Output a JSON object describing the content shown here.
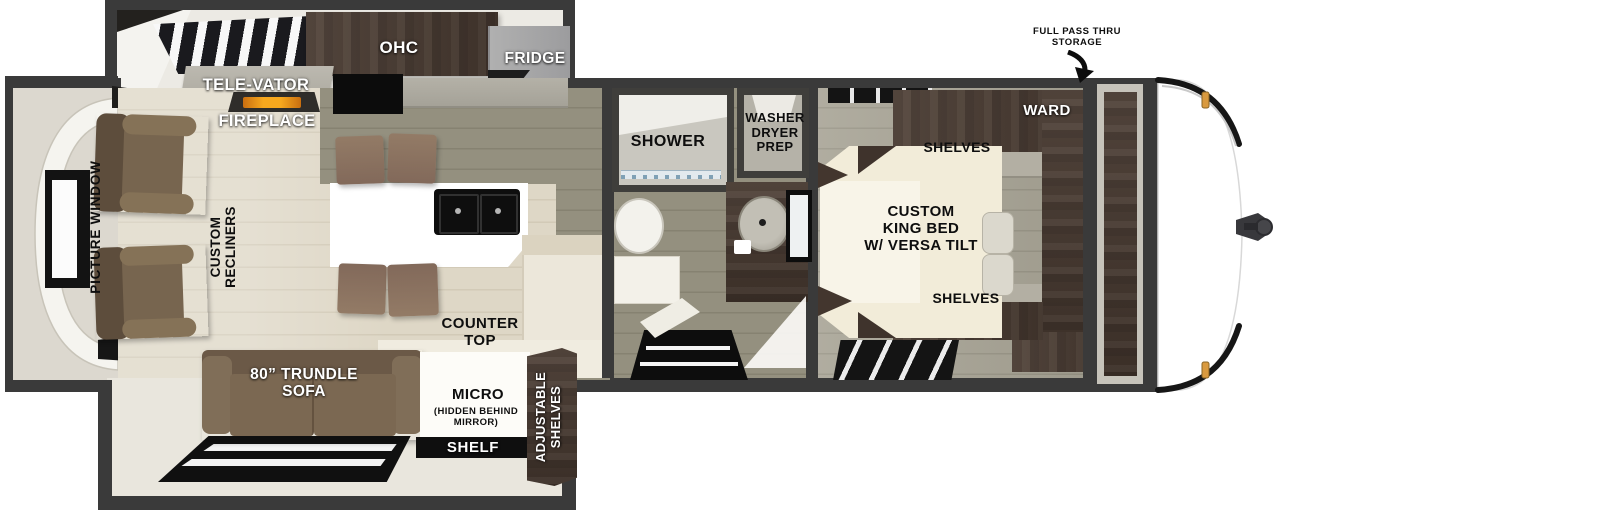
{
  "title": "Travel trailer floor plan",
  "colors": {
    "wall": "#3a3a3a",
    "floor_light": "#ded7c6",
    "floor_gray": "#94907f",
    "wood_dark": "#46382f",
    "sofa_brown": "#7b6a57",
    "bed_cream": "#f2ecd9",
    "island_white": "#ffffff",
    "fireplace_orange": "#f0961c",
    "marker_amber": "#d99a3f",
    "label_white": "#ffffff",
    "label_black": "#0e0e0e"
  },
  "labels": {
    "ohc": "OHC",
    "fridge": "FRIDGE",
    "televator": "TELE-VATOR",
    "fireplace": "FIREPLACE",
    "picture_window": "PICTURE WINDOW",
    "custom_recliners": "CUSTOM\nRECLINERS",
    "shower": "SHOWER",
    "washer_dryer_prep": "WASHER\nDRYER\nPREP",
    "ward": "WARD",
    "shelves_top": "SHELVES",
    "shelves_bottom": "SHELVES",
    "king_bed": "CUSTOM\nKING BED\nW/ VERSA TILT",
    "counter_top": "COUNTER\nTOP",
    "trundle_sofa": "80” TRUNDLE\nSOFA",
    "micro": "MICRO",
    "micro_note": "(HIDDEN BEHIND\nMIRROR)",
    "shelf": "SHELF",
    "adjustable_shelves": "ADJUSTABLE\nSHELVES",
    "pass_thru_storage": "FULL PASS THRU\nSTORAGE"
  }
}
